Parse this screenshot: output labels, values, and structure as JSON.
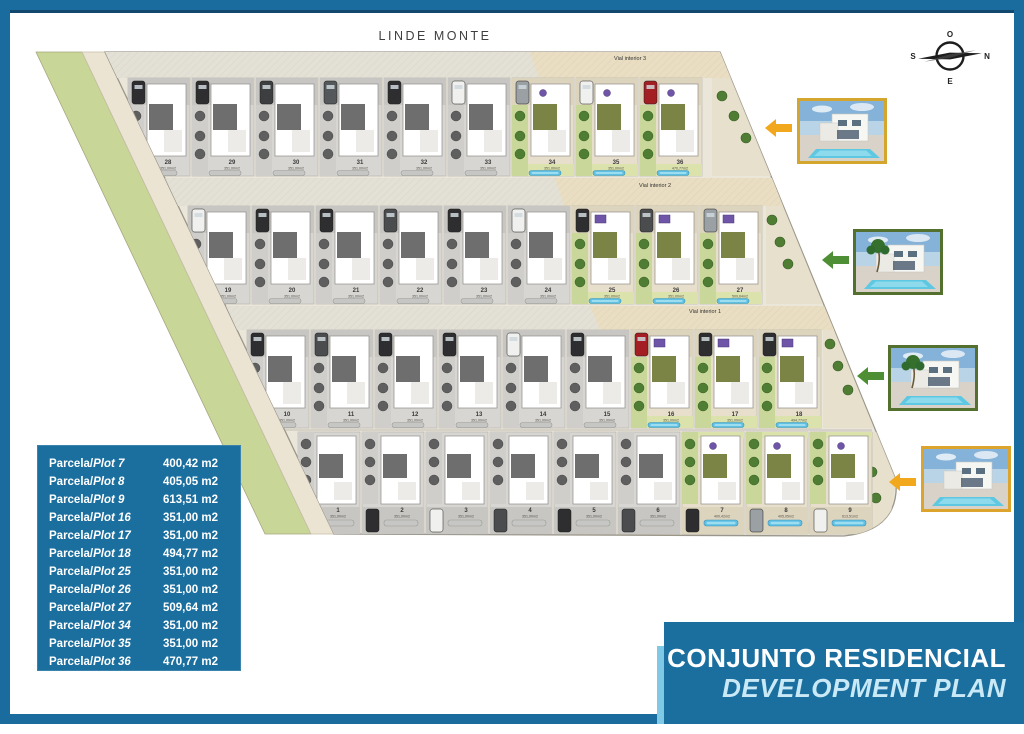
{
  "header": {
    "street": "LINDE MONTE"
  },
  "compass": {
    "top": "O",
    "right": "N",
    "bottom": "E",
    "left": "S"
  },
  "roads": [
    {
      "label": "Vial interior 3"
    },
    {
      "label": "Vial interior 2"
    },
    {
      "label": "Vial interior 1"
    }
  ],
  "site": {
    "rows": [
      {
        "plots": [
          {
            "n": "28",
            "area": "351,00m2",
            "colored": false,
            "car": "#2e2e30"
          },
          {
            "n": "29",
            "area": "351,00m2",
            "colored": false,
            "car": "#2e2e30"
          },
          {
            "n": "30",
            "area": "351,00m2",
            "colored": false,
            "car": "#3c3e40"
          },
          {
            "n": "31",
            "area": "351,00m2",
            "colored": false,
            "car": "#55585a"
          },
          {
            "n": "32",
            "area": "351,00m2",
            "colored": false,
            "car": "#2e2e30"
          },
          {
            "n": "33",
            "area": "351,00m2",
            "colored": false,
            "car": "#f0f0ee"
          },
          {
            "n": "34",
            "area": "351,00m2",
            "colored": true,
            "car": "#9aa0a4"
          },
          {
            "n": "35",
            "area": "351,00m2",
            "colored": true,
            "car": "#f0f0ee"
          },
          {
            "n": "36",
            "area": "470,77m2",
            "colored": true,
            "car": "#a31f24"
          }
        ]
      },
      {
        "plots": [
          {
            "n": "19",
            "area": "351,00m2",
            "colored": false,
            "car": "#f0f0ee"
          },
          {
            "n": "20",
            "area": "351,00m2",
            "colored": false,
            "car": "#2e2e30"
          },
          {
            "n": "21",
            "area": "351,00m2",
            "colored": false,
            "car": "#2e2e30"
          },
          {
            "n": "22",
            "area": "351,00m2",
            "colored": false,
            "car": "#4a4c4e"
          },
          {
            "n": "23",
            "area": "351,00m2",
            "colored": false,
            "car": "#2e2e30"
          },
          {
            "n": "24",
            "area": "351,00m2",
            "colored": false,
            "car": "#f0f0ee"
          },
          {
            "n": "25",
            "area": "351,00m2",
            "colored": true,
            "car": "#2e2e30"
          },
          {
            "n": "26",
            "area": "351,00m2",
            "colored": true,
            "car": "#4a4c4e"
          },
          {
            "n": "27",
            "area": "509,64m2",
            "colored": true,
            "car": "#9aa0a4"
          }
        ]
      },
      {
        "plots": [
          {
            "n": "10",
            "area": "351,00m2",
            "colored": false,
            "car": "#2e2e30"
          },
          {
            "n": "11",
            "area": "351,00m2",
            "colored": false,
            "car": "#4a4c4e"
          },
          {
            "n": "12",
            "area": "351,00m2",
            "colored": false,
            "car": "#2e2e30"
          },
          {
            "n": "13",
            "area": "351,00m2",
            "colored": false,
            "car": "#2e2e30"
          },
          {
            "n": "14",
            "area": "351,00m2",
            "colored": false,
            "car": "#f0f0ee"
          },
          {
            "n": "15",
            "area": "351,00m2",
            "colored": false,
            "car": "#2e2e30"
          },
          {
            "n": "16",
            "area": "351,00m2",
            "colored": true,
            "car": "#a31f24"
          },
          {
            "n": "17",
            "area": "351,00m2",
            "colored": true,
            "car": "#2e2e30"
          },
          {
            "n": "18",
            "area": "494,77m2",
            "colored": true,
            "car": "#2e2e30"
          }
        ]
      },
      {
        "plots": [
          {
            "n": "1",
            "area": "351,00m2",
            "colored": false,
            "car": "#4a4c4e"
          },
          {
            "n": "2",
            "area": "351,00m2",
            "colored": false,
            "car": "#2e2e30"
          },
          {
            "n": "3",
            "area": "351,00m2",
            "colored": false,
            "car": "#f0f0ee"
          },
          {
            "n": "4",
            "area": "351,00m2",
            "colored": false,
            "car": "#4a4c4e"
          },
          {
            "n": "5",
            "area": "351,00m2",
            "colored": false,
            "car": "#2e2e30"
          },
          {
            "n": "6",
            "area": "351,00m2",
            "colored": false,
            "car": "#4a4c4e"
          },
          {
            "n": "7",
            "area": "400,42m2",
            "colored": true,
            "car": "#2e2e30"
          },
          {
            "n": "8",
            "area": "405,05m2",
            "colored": true,
            "car": "#9aa0a4"
          },
          {
            "n": "9",
            "area": "613,51m2",
            "colored": true,
            "car": "#f0f0ee"
          }
        ]
      }
    ]
  },
  "legend": {
    "label_prefix": "Parcela/",
    "rows": [
      {
        "plot": "Plot 7",
        "area": "400,42 m2"
      },
      {
        "plot": "Plot 8",
        "area": "405,05 m2"
      },
      {
        "plot": "Plot 9",
        "area": "613,51 m2"
      },
      {
        "plot": "Plot 16",
        "area": "351,00 m2"
      },
      {
        "plot": "Plot 17",
        "area": "351,00 m2"
      },
      {
        "plot": "Plot 18",
        "area": "494,77 m2"
      },
      {
        "plot": "Plot 25",
        "area": "351,00 m2"
      },
      {
        "plot": "Plot 26",
        "area": "351,00 m2"
      },
      {
        "plot": "Plot 27",
        "area": "509,64 m2"
      },
      {
        "plot": "Plot 34",
        "area": "351,00 m2"
      },
      {
        "plot": "Plot 35",
        "area": "351,00 m2"
      },
      {
        "plot": "Plot 36",
        "area": "470,77 m2"
      }
    ]
  },
  "title": {
    "line1": "CONJUNTO RESIDENCIAL",
    "line2": "DEVELOPMENT PLAN"
  },
  "photos": [
    {
      "name": "villa-photo-1",
      "border_color": "#d4a62e",
      "arrow_color": "#f2a81d",
      "palm": false
    },
    {
      "name": "villa-photo-2",
      "border_color": "#54702f",
      "arrow_color": "#4e8f35",
      "palm": true
    },
    {
      "name": "villa-photo-3",
      "border_color": "#54702f",
      "arrow_color": "#4e8f35",
      "palm": true
    },
    {
      "name": "villa-photo-4",
      "border_color": "#dca42c",
      "arrow_color": "#f2a81d",
      "palm": false
    }
  ],
  "colors": {
    "frame": "#1a6b9e",
    "frame_dark": "#13486e",
    "panel_blue": "#1b6f9f",
    "accent_light": "#7fc9e6",
    "title_line2": "#c9e9f6",
    "green_strip": "#c8d698",
    "path_strip": "#ece4d2",
    "site_base": "#ebe6da",
    "road_gray": "#e3e0d6",
    "road_sand": "#e9ddc2",
    "plot_gray": "#d7d6d3",
    "plot_sand": "#e7dfcb",
    "garden": "#c9d79b",
    "lawn": "#dbe2ac",
    "roof_gray": "#6e6e6e",
    "roof_olive": "#7b8444",
    "pool_blue": "#5fc0e4",
    "pool_gray": "#c6c6c4",
    "tree_green": "#4e7d33",
    "tree_gray": "#5f5f5f",
    "solar_purple": "#6f55a8"
  }
}
